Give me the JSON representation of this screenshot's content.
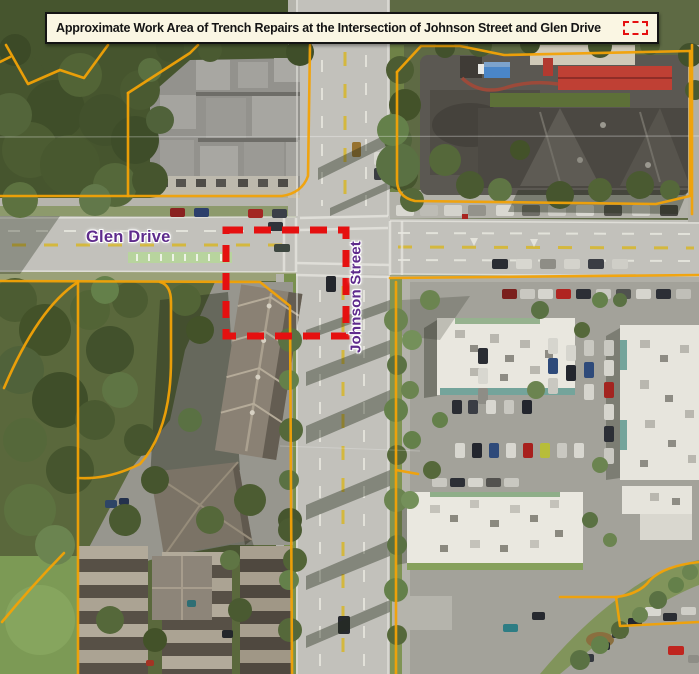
{
  "banner": {
    "title": "Approximate Work Area of Trench Repairs at the Intersection of Johnson Street and Glen Drive",
    "legend_icon": "work-area-dashed-rectangle"
  },
  "map": {
    "street_labels": [
      {
        "name": "Glen Drive",
        "orientation": "horizontal"
      },
      {
        "name": "Johnson Street",
        "orientation": "vertical"
      }
    ],
    "work_area": {
      "label": "Approximate work area of trench repairs",
      "shape": "red-dashed-rectangle",
      "x": 226,
      "y": 230,
      "width": 120,
      "height": 106
    }
  },
  "colors": {
    "banner_bg": "#faf6e3",
    "banner_border": "#141414",
    "banner_text": "#141414",
    "work_area_red": "#e51010",
    "parcel_orange": "#f2a206",
    "street_label_purple": "#5e2b8c"
  }
}
